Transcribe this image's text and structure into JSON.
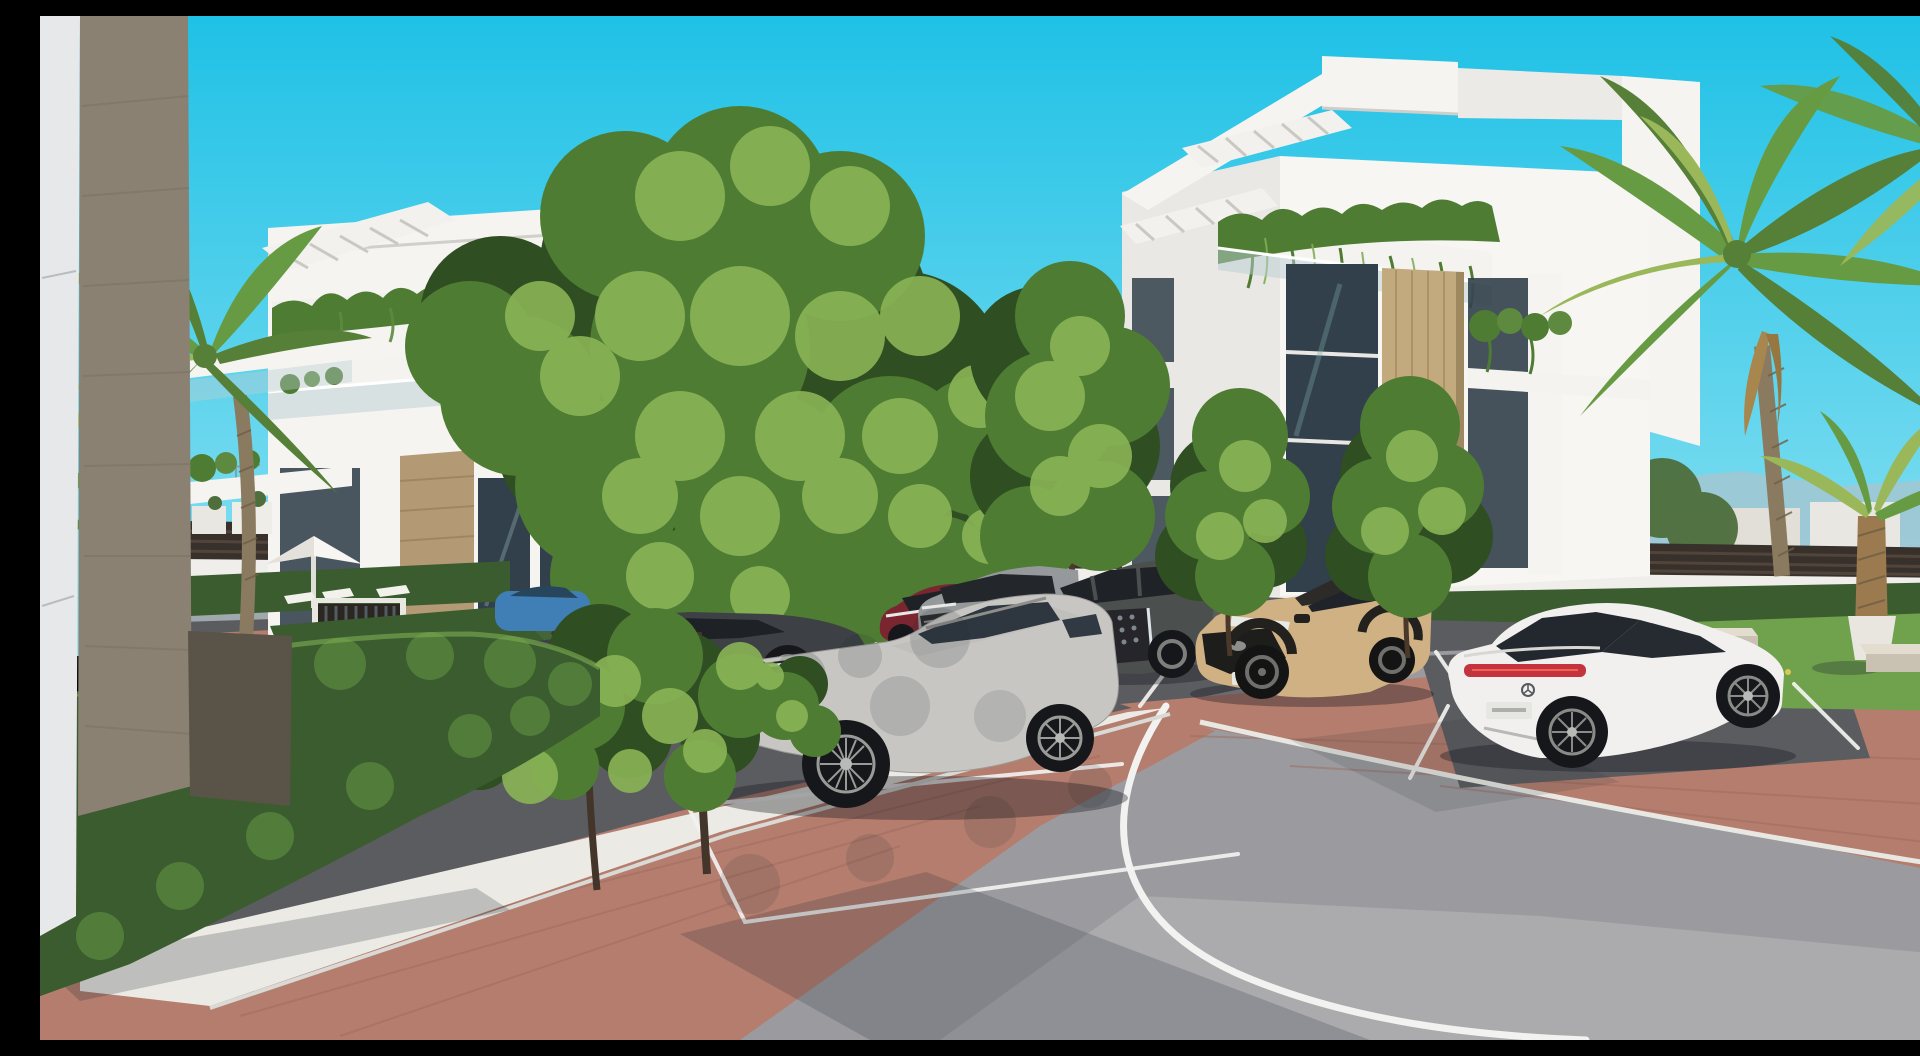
{
  "image_alt": "Photorealistic 3D architectural rendering of a modern white apartment complex: two multi-storey buildings with planted balconies, glass balustrades and rooftop pergolas, palm trees and clipped hedges, a brick-paved walkway with a white gravel border, residential parking bays with parked cars and a curving grey asphalt access road under a clear turquoise sky.",
  "palette": {
    "sky_top": "#1fc1e6",
    "sky_horizon": "#8fe2f2",
    "mountain": "#a9c3cd",
    "distant_building": "#e9e7e1",
    "wall_white": "#efeeea",
    "fence_dark": "#38302a",
    "fence_rail": "#6b5b4c",
    "building_white": "#f5f4f1",
    "building_shadow": "#dddcd7",
    "stone_tan": "#b49a74",
    "timber_tan": "#c3a97e",
    "corner_white": "#e7e8ea",
    "corner_stone": "#8a8173",
    "corner_stone_dark": "#5a5347",
    "glass_dark": "#31404a",
    "balustrade_glass": "#b9ced2",
    "hedge_green": "#3a5c2e",
    "hedge_light": "#5d8a3f",
    "tree_green": "#4f7c33",
    "tree_dark": "#2f4e22",
    "tree_light": "#8ab456",
    "distant_tree": "#4e6e3c",
    "palm_green": "#679b43",
    "palm_light": "#9ab85a",
    "palm_trunk": "#8a7a5f",
    "grass": "#70a14c",
    "asphalt_parking": "#5b5c60",
    "asphalt_road": "#9b9b9f",
    "distant_road": "#9fa8ac",
    "brick": "#b47d6e",
    "brick_dark": "#9c685c",
    "gravel": "#eceae4",
    "line_white": "#f2f2f0",
    "curb_light": "#d9d9d5",
    "bench_stone": "#e3ddcf",
    "shadow": "#1c2730"
  },
  "buildings": {
    "left": {
      "label": "left apartment building",
      "storeys": 4,
      "facade": "white render, sand-stone column, glass balustrades, hanging balcony plants, rooftop pergola"
    },
    "right": {
      "label": "right apartment building",
      "storeys": 4,
      "facade": "white cantilevered balconies, timber feature wall, cascading balcony plants, rooftop pergolas"
    },
    "foreground_corner": {
      "label": "foreground building corner",
      "facade": "white panel edge with sand-stone pillar"
    }
  },
  "vehicles": [
    {
      "name": "silver Mercedes SUV",
      "body": "SUV",
      "color": "#c8c6c2"
    },
    {
      "name": "white Mercedes fastback sedan",
      "body": "sedan",
      "color": "#f1f0ee",
      "tail_light_color": "#c4343c"
    },
    {
      "name": "tan Toyota compact SUV",
      "body": "compact SUV",
      "color": "#cfb184",
      "roof_color": "#2d2b27"
    },
    {
      "name": "dark grey SUV",
      "body": "SUV",
      "color": "#4b4f4e"
    },
    {
      "name": "grey SUV",
      "body": "SUV",
      "color": "#96999c"
    },
    {
      "name": "dark red hatchback",
      "body": "hatchback",
      "color": "#7a2530"
    },
    {
      "name": "dark grey sedan",
      "body": "sedan",
      "color": "#3d4045"
    },
    {
      "name": "blue car",
      "body": "car",
      "color": "#3f7fb5"
    },
    {
      "name": "distant grey car",
      "body": "sedan",
      "color": "#9aa0a4"
    }
  ],
  "landscape": {
    "palms": 7,
    "hedges": "clipped box hedges lining gardens and parking",
    "lawns": "green lawns with concrete benches and a potted palm",
    "surfaces": [
      "grey asphalt road",
      "red-brown brick pavers",
      "white gravel border",
      "white painted parking lines"
    ]
  },
  "furniture": {
    "parasol": "white garden parasol",
    "sun_loungers": 3,
    "benches": 2,
    "gate": "dark slatted garden gate",
    "perimeter": "white wall topped with dark slatted fence"
  }
}
